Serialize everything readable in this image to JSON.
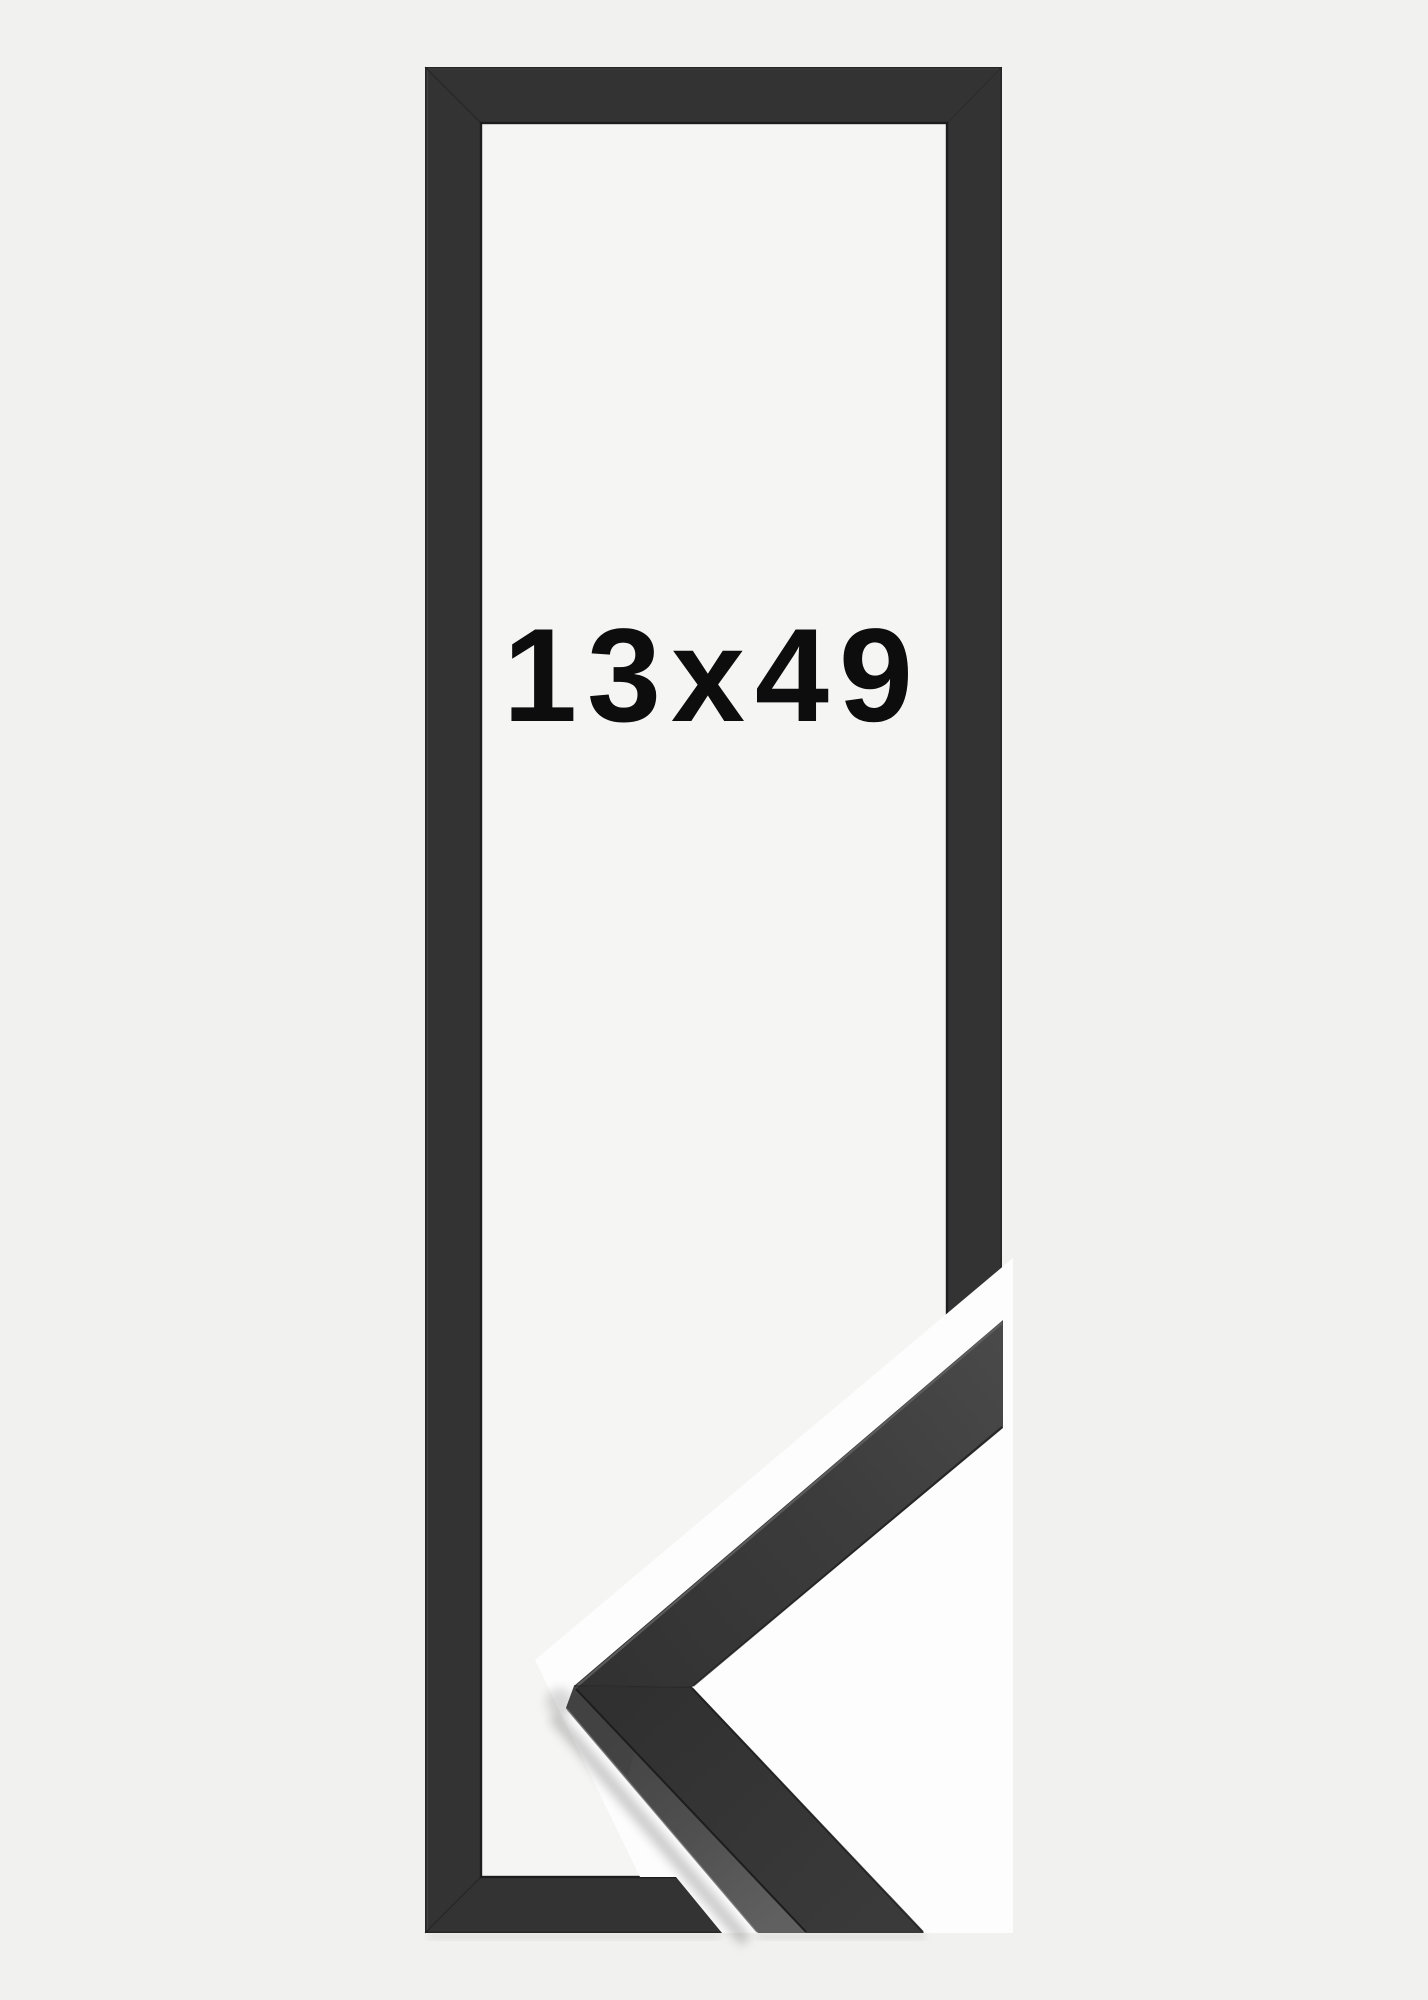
{
  "image": {
    "size_label": "13x49",
    "colors": {
      "background": "#f1f1ef",
      "opening": "#f5f5f4",
      "backdrop": "#fdfdfd",
      "frame_face": "#333333",
      "frame_inner_edge": "#1d1d1d",
      "frame_outer_edge": "#272727",
      "sample_face_dark": "#2f2f2f",
      "sample_face_light": "#4a4a4a",
      "sample_side_face": "#575757",
      "label_text": "#0d0d0d"
    }
  }
}
